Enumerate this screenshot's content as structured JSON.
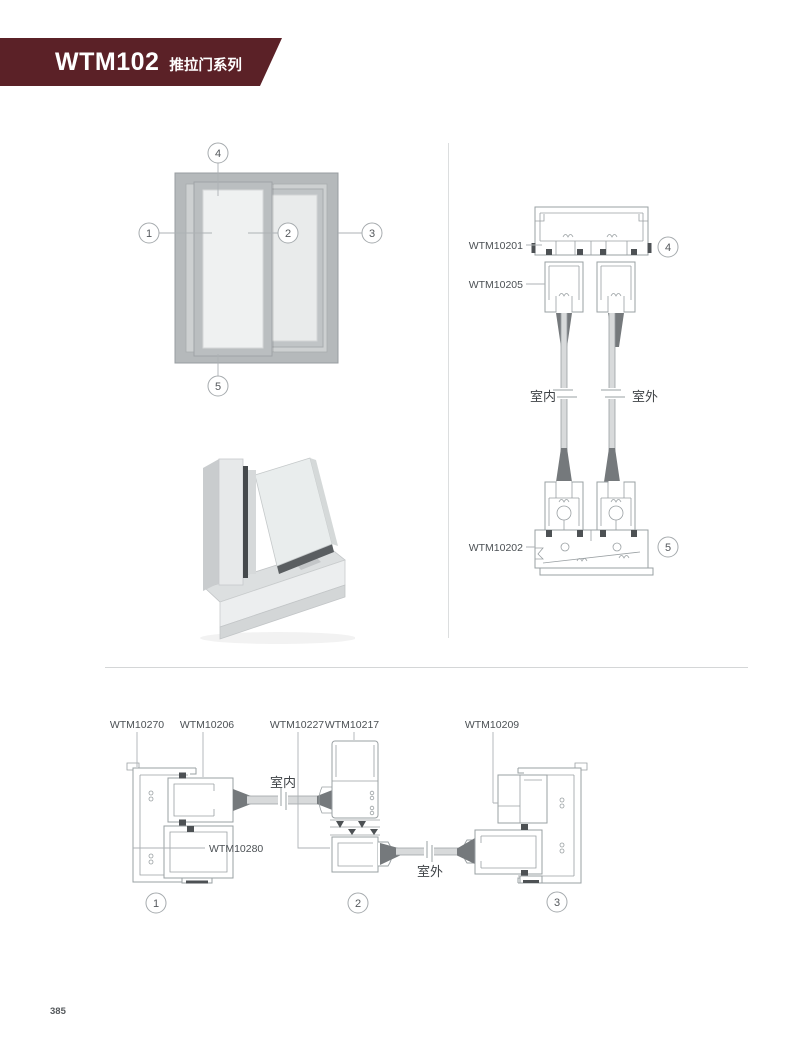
{
  "header": {
    "series_code": "WTM102",
    "series_name": "推拉门系列",
    "banner_color": "#5b2127"
  },
  "elevation": {
    "callout_top": "4",
    "callout_left": "1",
    "callout_center": "2",
    "callout_right": "3",
    "callout_bottom": "5"
  },
  "vertical_section": {
    "label_head": "WTM10201",
    "label_sash_top": "WTM10205",
    "label_sill": "WTM10202",
    "indoor": "室内",
    "outdoor": "室外",
    "callout_head": "4",
    "callout_sill": "5"
  },
  "horizontal_section": {
    "label_jamb_left": "WTM10270",
    "label_sash_left": "WTM10206",
    "label_interlock": "WTM10227",
    "label_meeting_stile": "WTM10217",
    "label_jamb_right": "WTM10209",
    "label_cover": "WTM10280",
    "indoor": "室内",
    "outdoor": "室外",
    "callout_left": "1",
    "callout_center": "2",
    "callout_right": "3"
  },
  "footer": {
    "page_number": "385"
  },
  "colors": {
    "banner": "#5b2127",
    "drawing_line": "#9aa0a3",
    "gasket_dark": "#4d5154",
    "glass_gray": "#d8dadb"
  }
}
